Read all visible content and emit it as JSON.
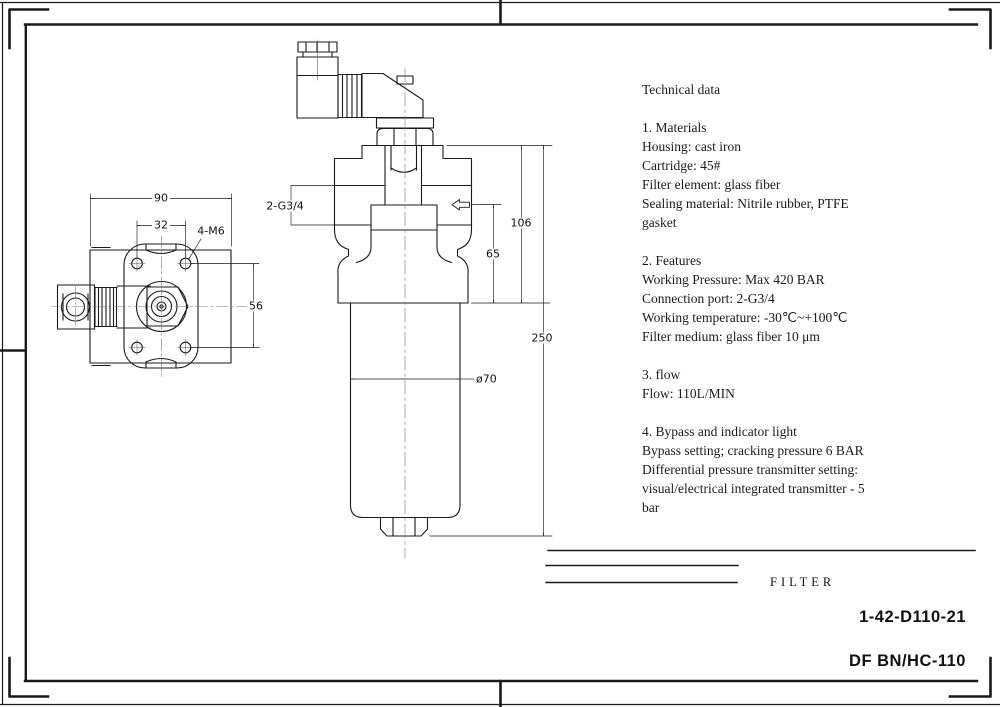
{
  "tech": {
    "title": "Technical data",
    "s1": [
      "1. Materials",
      "Housing: cast iron",
      "Cartridge: 45#",
      "Filter element: glass fiber",
      "Sealing material: Nitrile rubber, PTFE",
      "gasket"
    ],
    "s2": [
      "2. Features",
      "Working Pressure: Max 420 BAR",
      "Connection port: 2-G3/4",
      "Working temperature: -30℃~+100℃",
      "Filter medium: glass fiber 10 μm"
    ],
    "s3": [
      "3. flow",
      "Flow: 110L/MIN"
    ],
    "s4": [
      "4. Bypass and indicator light",
      "Bypass setting; cracking pressure 6 BAR",
      "Differential pressure transmitter setting:",
      "visual/electrical integrated transmitter - 5",
      "bar"
    ]
  },
  "dims": {
    "overall_width": "90",
    "hole_spacing": "32",
    "thread_callout": "4-M6",
    "hole_height": "56",
    "port_callout": "2-G3/4",
    "port_to_bowl": "65",
    "head_height": "106",
    "overall_height": "250",
    "bowl_diameter": "ø70"
  },
  "title_block": {
    "product_name": "FILTER",
    "drawing_number": "1-42-D110-21",
    "model_number": "DF BN/HC-110"
  }
}
